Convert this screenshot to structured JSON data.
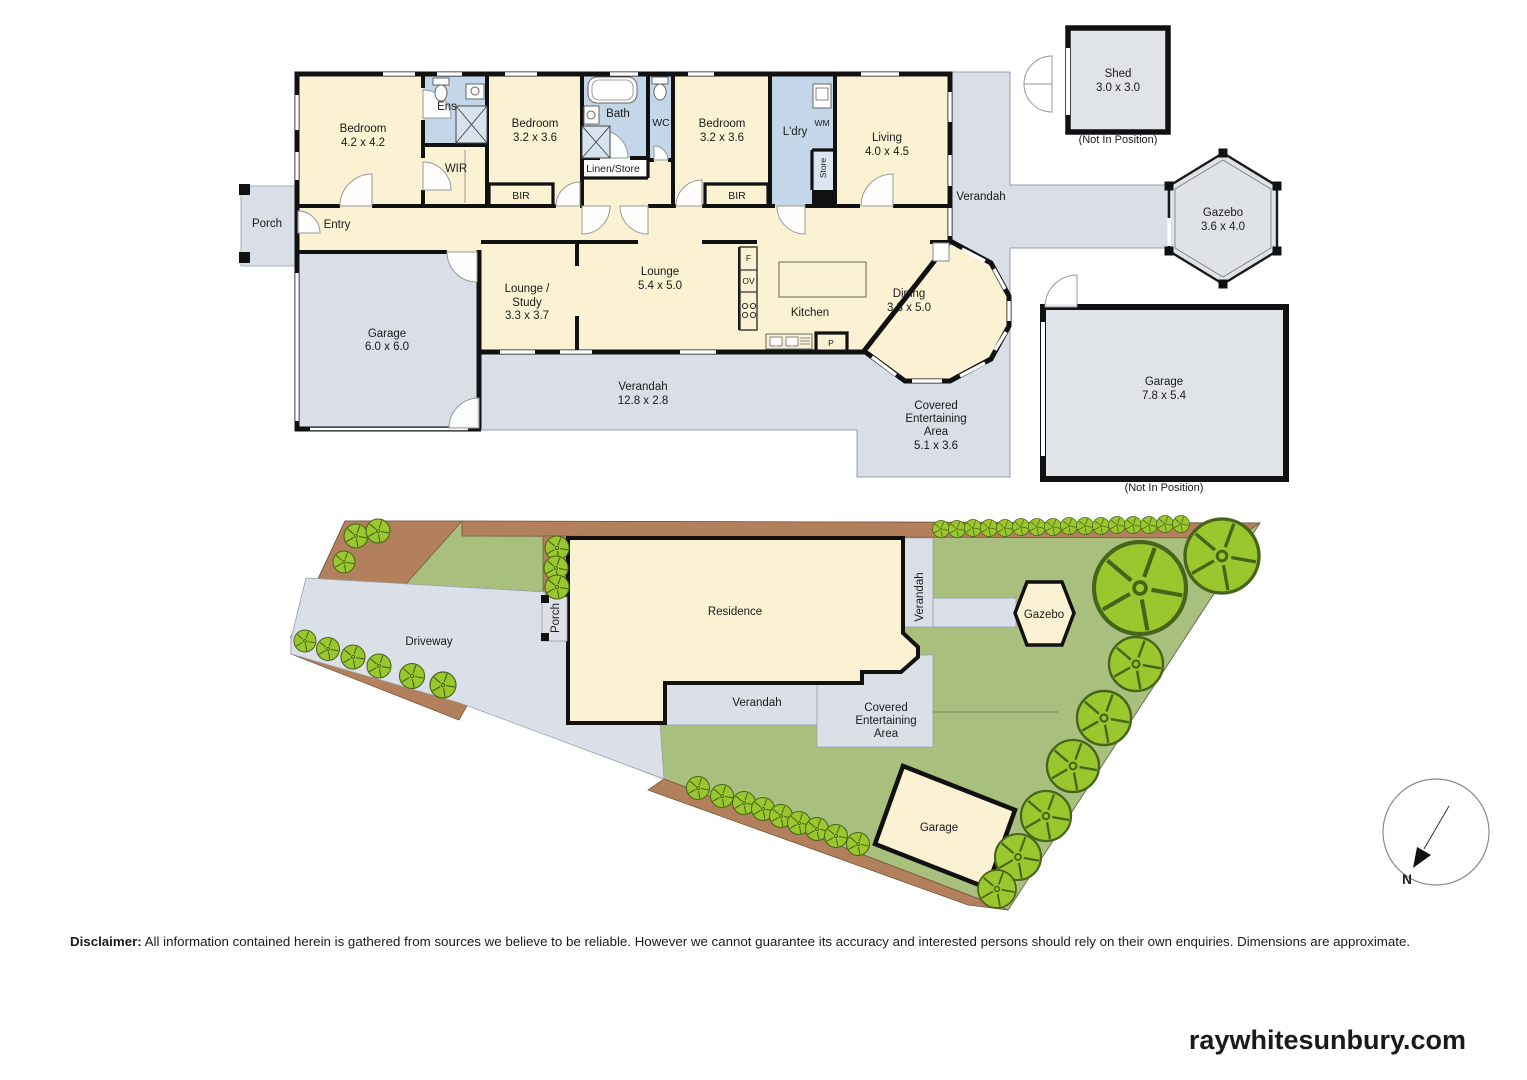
{
  "floorplan": {
    "porch": "Porch",
    "entry": "Entry",
    "bedroom1": {
      "label": "Bedroom",
      "dims": "4.2 x 4.2"
    },
    "ens": "Ens",
    "wir": "WIR",
    "bedroom2": {
      "label": "Bedroom",
      "dims": "3.2 x 3.6"
    },
    "bir1": "BIR",
    "bath": "Bath",
    "linen": "Linen/Store",
    "wc": "WC",
    "bedroom3": {
      "label": "Bedroom",
      "dims": "3.2 x 3.6"
    },
    "bir2": "BIR",
    "ldry": "L'dry",
    "wm": "WM",
    "store": "Store",
    "living": {
      "label": "Living",
      "dims": "4.0 x 4.5"
    },
    "verandah_right": "Verandah",
    "garage": {
      "label": "Garage",
      "dims": "6.0 x 6.0"
    },
    "lounge_study": {
      "line1": "Lounge /",
      "line2": "Study",
      "dims": "3.3 x 3.7"
    },
    "lounge": {
      "label": "Lounge",
      "dims": "5.4 x 5.0"
    },
    "kitchen": "Kitchen",
    "fridge": "F",
    "oven": "OV",
    "pantry": "P",
    "dining": {
      "label": "Dining",
      "dims": "3.3 x 5.0"
    },
    "verandah_bottom": {
      "label": "Verandah",
      "dims": "12.8 x 2.8"
    },
    "covered": {
      "line1": "Covered",
      "line2": "Entertaining",
      "line3": "Area",
      "dims": "5.1 x 3.6"
    },
    "shed": {
      "label": "Shed",
      "dims": "3.0 x 3.0",
      "note": "(Not In Position)"
    },
    "gazebo": {
      "label": "Gazebo",
      "dims": "3.6 x 4.0"
    },
    "garage2": {
      "label": "Garage",
      "dims": "7.8 x 5.4",
      "note": "(Not In Position)"
    }
  },
  "siteplan": {
    "driveway": "Driveway",
    "porch": "Porch",
    "residence": "Residence",
    "verandah_side": "Verandah",
    "gazebo": "Gazebo",
    "verandah_bottom": "Verandah",
    "covered": {
      "line1": "Covered",
      "line2": "Entertaining",
      "line3": "Area"
    },
    "garage": "Garage",
    "north": "N"
  },
  "footer": {
    "disclaimer_label": "Disclaimer:",
    "disclaimer_text": " All information contained herein is gathered from sources we believe to be reliable. However we cannot guarantee its accuracy and interested persons should rely on their own enquiries. Dimensions are approximate.",
    "website": "raywhitesunbury.com"
  },
  "colors": {
    "room": "#fbf2d3",
    "wet": "#c3d7e8",
    "outdoor": "#d9dee7",
    "grass": "#a9bf7d",
    "garden": "#b2805c",
    "tree": "#9bc72e",
    "wall": "#111111"
  }
}
